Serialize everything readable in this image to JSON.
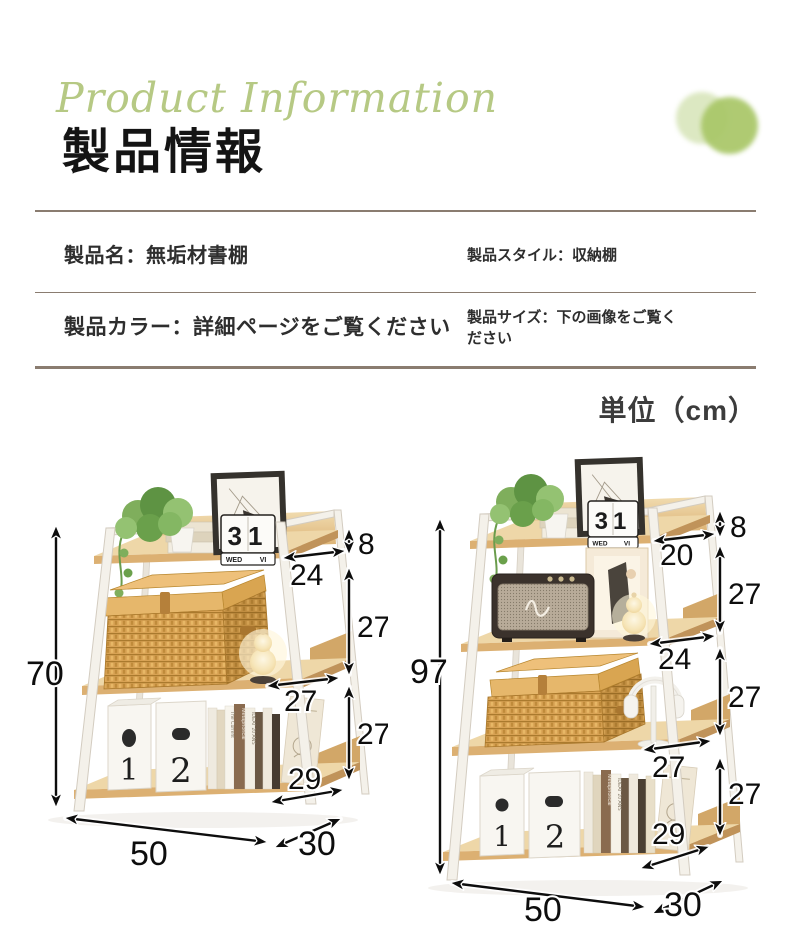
{
  "header": {
    "script_title": "Product Information",
    "title": "製品情報"
  },
  "info_table": {
    "row1": {
      "left": "製品名：無垢材書棚",
      "right": "製品スタイル：収納棚"
    },
    "row2": {
      "left": "製品カラー：詳細ページをご覧ください",
      "right": "製品サイズ：下の画像をご覧ください"
    }
  },
  "unit_label": "単位（cm）",
  "colors": {
    "accent_circle_light": "#dce8c2",
    "accent_circle_dark": "#a9c768",
    "divider": "#8a7c70",
    "wood": "#eed7a8",
    "frame_white": "#f4f1ea",
    "dimension_ink": "#0d0d0d"
  },
  "diagram_left": {
    "overall_height": "70",
    "top_gap": "8",
    "top_shelf_depth": "24",
    "tier2_height": "27",
    "mid_shelf_depth": "27",
    "tier3_height": "27",
    "bottom_shelf_depth": "29",
    "width": "50",
    "depth": "30",
    "calendar_day": "31",
    "calendar_weekday": "WED",
    "calendar_month": "VI",
    "box1": "1",
    "box2": "2",
    "book_spines": [
      "The Current",
      "Metaphorical",
      "IDEAT 20 ANS"
    ]
  },
  "diagram_right": {
    "overall_height": "97",
    "top_gap": "8",
    "top_shelf_depth": "20",
    "tier2_height": "27",
    "shelf2_depth": "24",
    "tier3_height": "27",
    "shelf3_depth": "27",
    "tier4_height": "27",
    "bottom_shelf_depth": "29",
    "width": "50",
    "depth": "30",
    "calendar_day": "31",
    "calendar_weekday": "WED",
    "calendar_month": "VI",
    "box1": "1",
    "box2": "2",
    "book_spines": [
      "Metaphorical",
      "IDEAT 20 ANS"
    ]
  }
}
